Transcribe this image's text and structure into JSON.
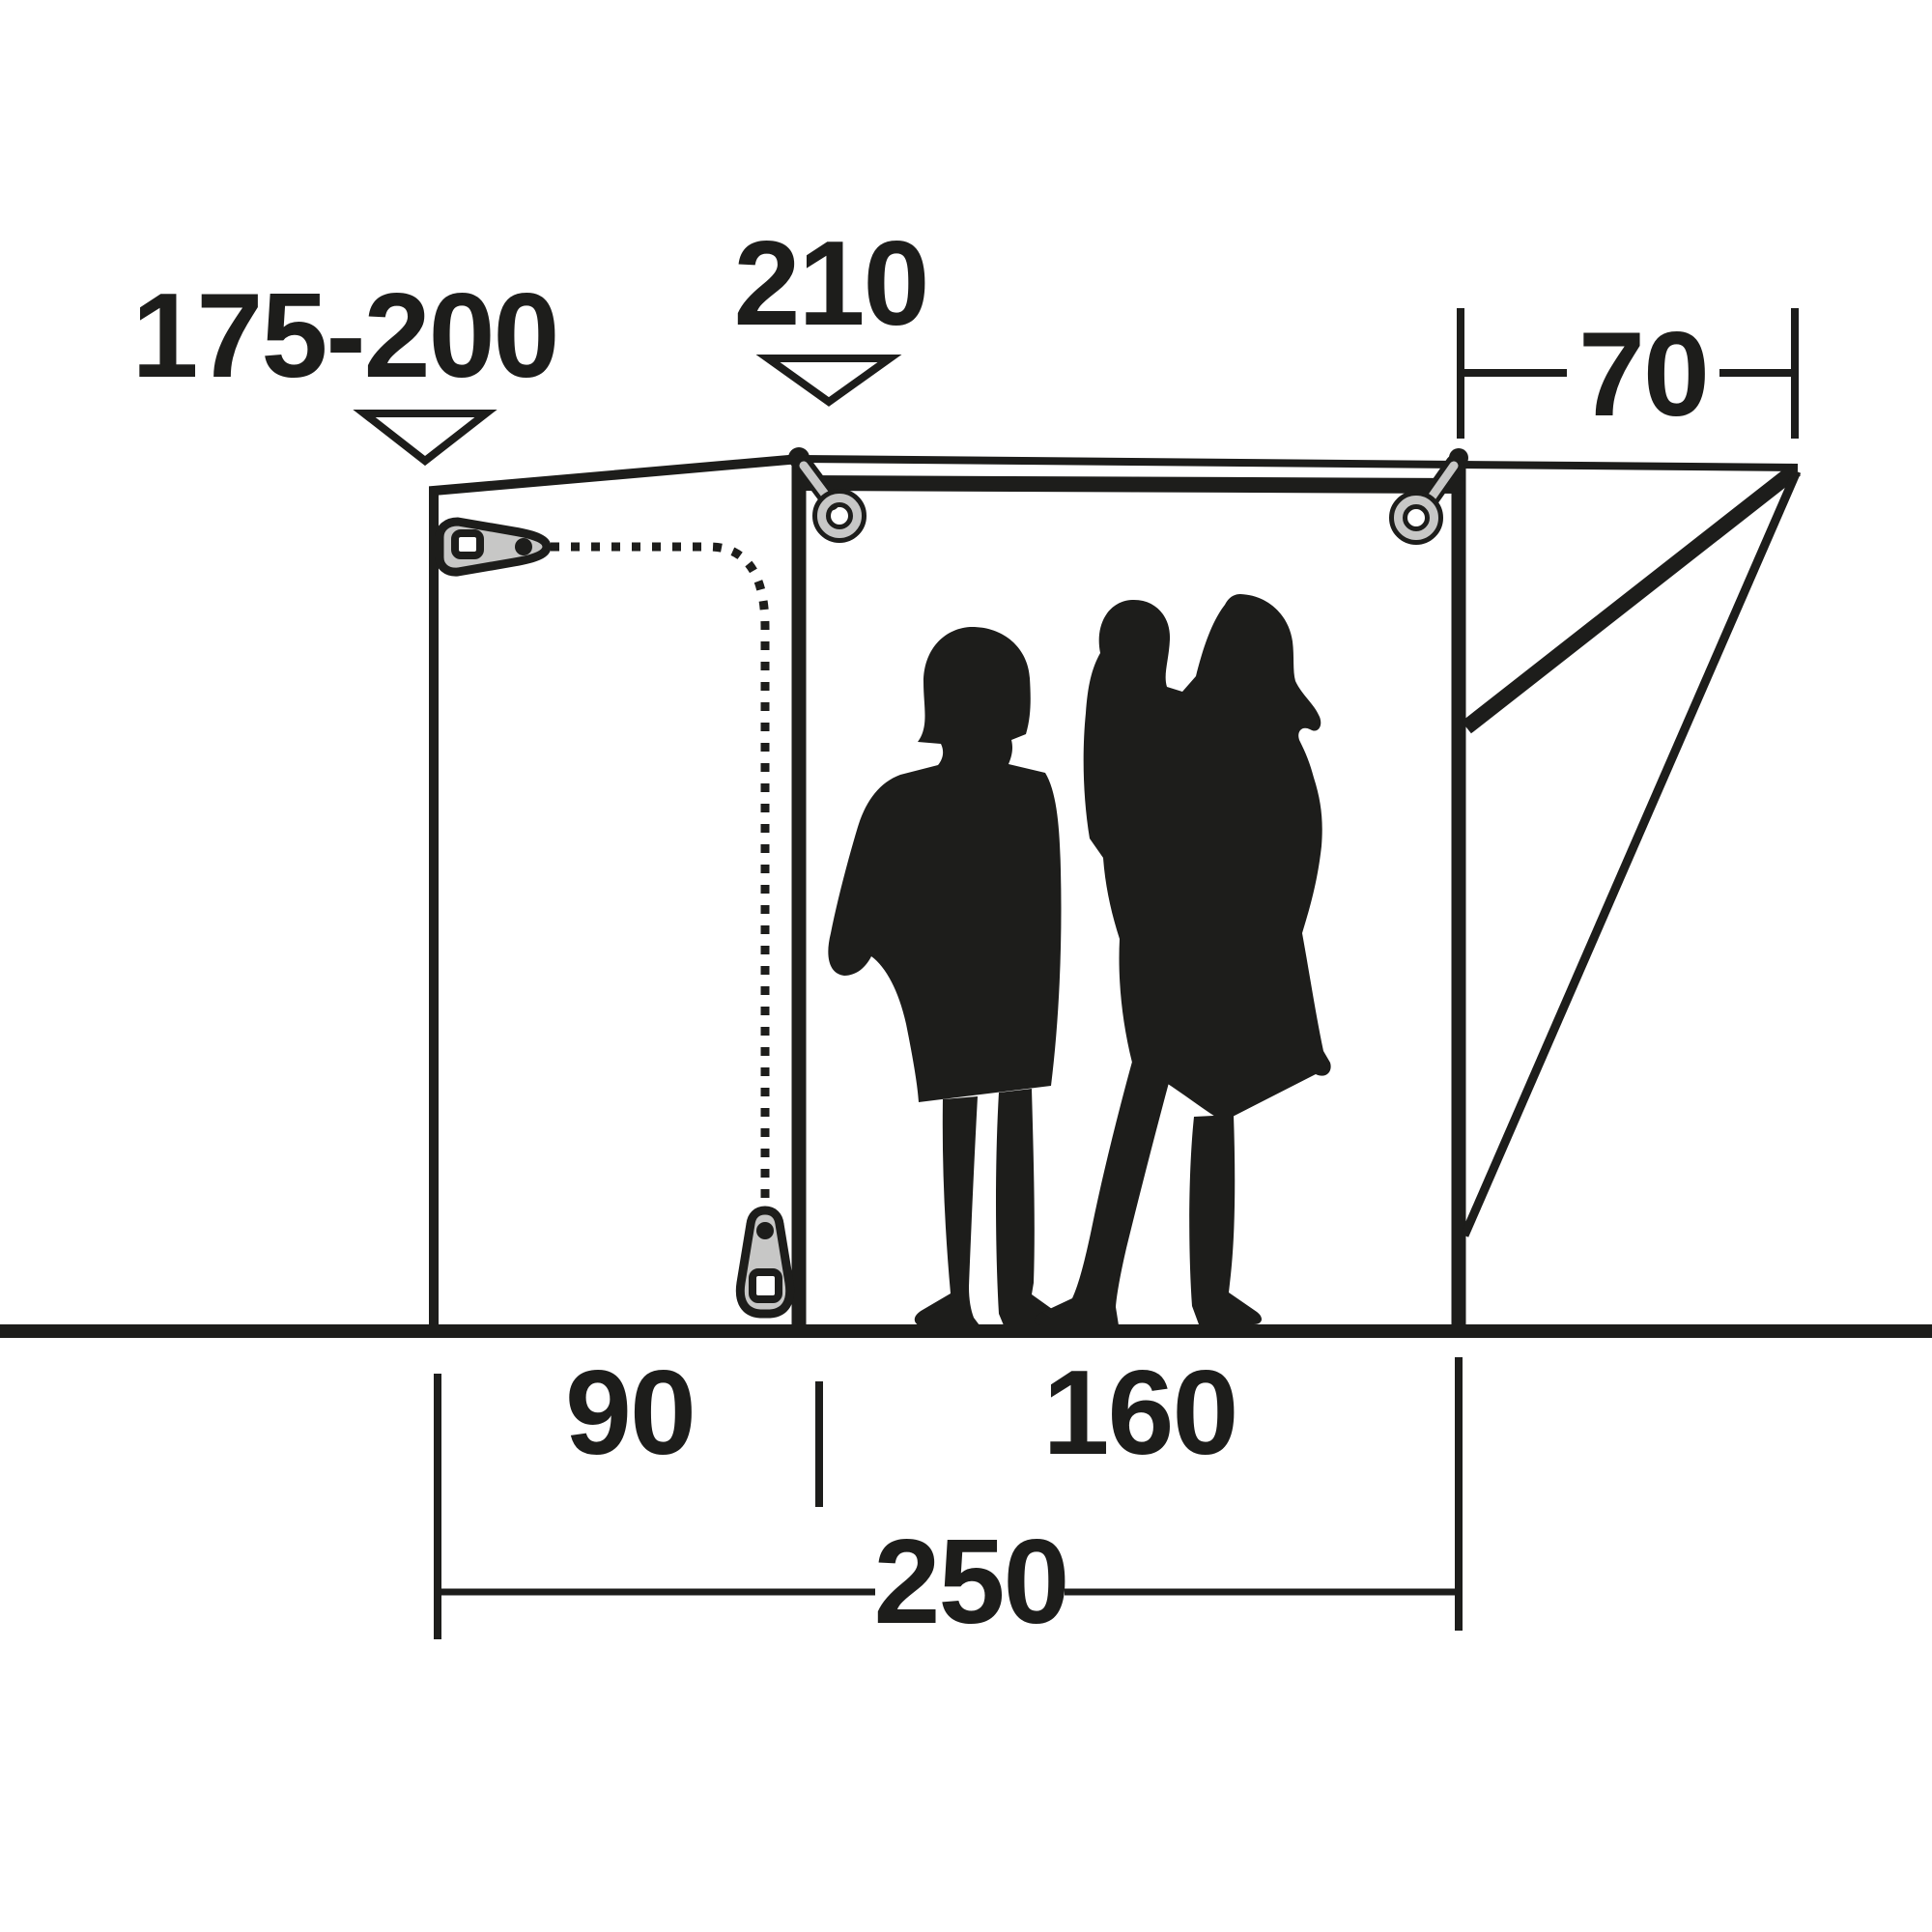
{
  "diagram": {
    "type": "awning-side-profile-dimension-diagram",
    "background_color": "#ffffff",
    "ink_color": "#1d1d1b",
    "hardware_gray_color": "#c7c7c6",
    "labels": {
      "height_range": "175-200",
      "peak_height": "210",
      "side_depth": "70",
      "left_section_width": "90",
      "front_section_width": "160",
      "total_width": "250"
    },
    "icons": [
      "pointer-triangle-icon",
      "zipper-pull-icon",
      "zipper-track-dotted-icon",
      "grommet-ring-icon",
      "family-silhouette"
    ]
  }
}
